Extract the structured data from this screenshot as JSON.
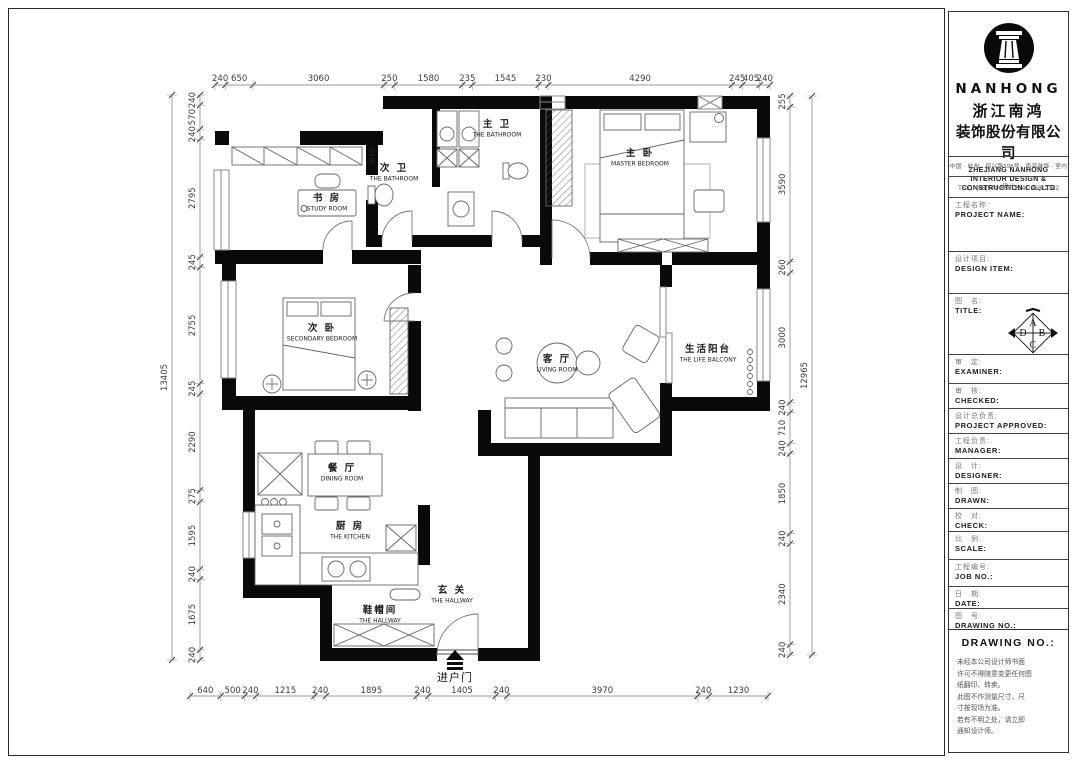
{
  "title_block": {
    "logo_icon": "column-icon",
    "logo_text": "NANHONG",
    "company_zh_1": "浙江南鸿",
    "company_zh_2": "装饰股份有限公司",
    "company_en_lines": [
      "ZHEJIANG NANHONG",
      "INTERIOR DESIGN &",
      "CONSTRUCTION CO.,LTD"
    ],
    "address": "中国 · 杭州 · 绍兴路598号 · 南鸿装饰 · 室内设计",
    "tel": "TEL：(86)571-85812341  85812342",
    "fields": [
      {
        "zh": "工程名称:",
        "en": "PROJECT NAME:"
      },
      {
        "zh": "设计项目:",
        "en": "DESIGN ITEM:"
      },
      {
        "zh": "图　名:",
        "en": "TITLE:"
      },
      {
        "zh": "审　定:",
        "en": "EXAMINER:"
      },
      {
        "zh": "审　核:",
        "en": "CHECKED:"
      },
      {
        "zh": "设计总负责:",
        "en": "PROJECT APPROVED:"
      },
      {
        "zh": "工程负责:",
        "en": "MANAGER:"
      },
      {
        "zh": "设　计:",
        "en": "DESIGNER:"
      },
      {
        "zh": "制　图:",
        "en": "DRAWN:"
      },
      {
        "zh": "校　对:",
        "en": "CHECK:"
      },
      {
        "zh": "比　例:",
        "en": "SCALE:"
      },
      {
        "zh": "工程编号:",
        "en": "JOB  NO.:"
      },
      {
        "zh": "日　期:",
        "en": "DATE:"
      },
      {
        "zh": "图　号:",
        "en": "DRAWING NO.:"
      }
    ],
    "compass_letters": [
      "A",
      "B",
      "C",
      "D"
    ],
    "drawing_no_header": "DRAWING  NO.:",
    "notes": [
      "未经本公司设计师书面",
      "许可不得随意变更任何图",
      "纸翻印、转卖。",
      "此图不作测量尺寸，尺",
      "寸按现场为准。",
      "若有不明之处，请立即",
      "通知设计师。"
    ]
  },
  "plan": {
    "rooms": [
      {
        "zh": "书 房",
        "en": "STUDY ROOM"
      },
      {
        "zh": "次 卫",
        "en": "THE BATHROOM"
      },
      {
        "zh": "主 卫",
        "en": "THE BATHROOM"
      },
      {
        "zh": "主 卧",
        "en": "MASTER BEDROOM"
      },
      {
        "zh": "次 卧",
        "en": "SECONDARY BEDROOM"
      },
      {
        "zh": "客 厅",
        "en": "LIVING ROOM"
      },
      {
        "zh": "生活阳台",
        "en": "THE LIFE BALCONY"
      },
      {
        "zh": "餐 厅",
        "en": "DINING ROOM"
      },
      {
        "zh": "厨 房",
        "en": "THE KITCHEN"
      },
      {
        "zh": "玄 关",
        "en": "THE HALLWAY"
      },
      {
        "zh": "鞋帽间",
        "en": "THE HALLWAY"
      }
    ],
    "entry_label": "进户门",
    "niche_label": "壁龛",
    "dims": {
      "top": [
        240,
        650,
        3060,
        250,
        1580,
        235,
        1545,
        230,
        4290,
        245,
        405,
        240
      ],
      "bottom": [
        640,
        500,
        240,
        1215,
        240,
        1895,
        240,
        1405,
        240,
        3970,
        240,
        1230
      ],
      "left": [
        240,
        570,
        240,
        2795,
        245,
        2755,
        245,
        2290,
        275,
        1595,
        240,
        1675,
        240
      ],
      "left_total": "13405",
      "right": [
        255,
        3590,
        260,
        3000,
        240,
        710,
        240,
        1850,
        240,
        2340,
        240
      ],
      "right_total": "12965"
    }
  }
}
